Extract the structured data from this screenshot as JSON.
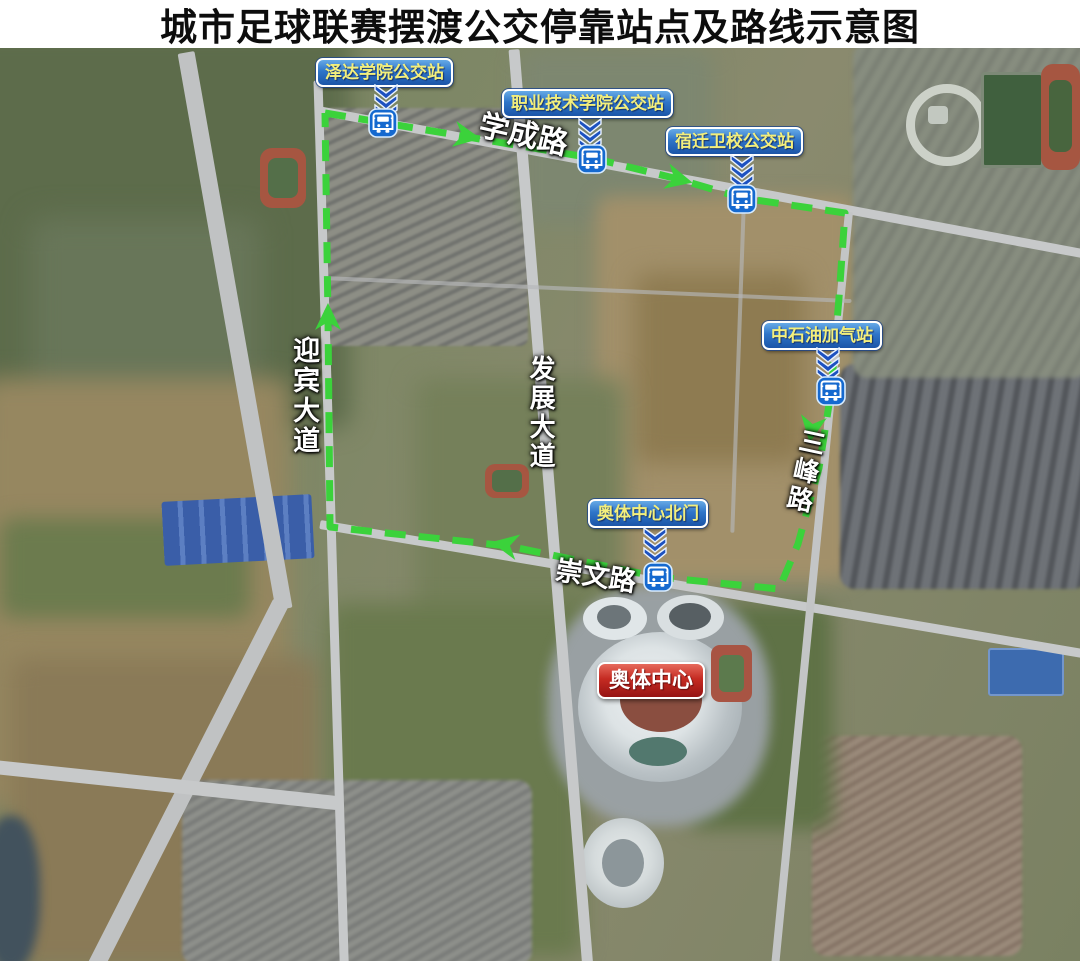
{
  "title": "城市足球联赛摆渡公交停靠站点及路线示意图",
  "map": {
    "stations": [
      {
        "id": "zeda-college",
        "name": "泽达学院公交站",
        "label": {
          "x": 316,
          "y": 10
        },
        "chevron": {
          "x": 373,
          "y": 36
        },
        "bus": {
          "x": 368,
          "y": 60
        }
      },
      {
        "id": "vocational-college",
        "name": "职业技术学院公交站",
        "label": {
          "x": 502,
          "y": 41
        },
        "chevron": {
          "x": 577,
          "y": 70
        },
        "bus": {
          "x": 577,
          "y": 96
        }
      },
      {
        "id": "suqian-health-school",
        "name": "宿迁卫校公交站",
        "label": {
          "x": 666,
          "y": 79
        },
        "chevron": {
          "x": 729,
          "y": 106
        },
        "bus": {
          "x": 727,
          "y": 136
        }
      },
      {
        "id": "petrochina-gas",
        "name": "中石油加气站",
        "label": {
          "x": 762,
          "y": 273
        },
        "chevron": {
          "x": 815,
          "y": 299
        },
        "bus": {
          "x": 816,
          "y": 328
        }
      },
      {
        "id": "octc-north-gate",
        "name": "奥体中心北门",
        "label": {
          "x": 588,
          "y": 451
        },
        "chevron": {
          "x": 642,
          "y": 479
        },
        "bus": {
          "x": 643,
          "y": 514
        }
      }
    ],
    "destination": {
      "name": "奥体中心",
      "x": 597,
      "y": 614
    },
    "roads": [
      {
        "id": "xuecheng-road",
        "name": "学成路",
        "x": 483,
        "y": 62,
        "rotate": 13,
        "vertical": false,
        "size": 30
      },
      {
        "id": "yingbin-avenue",
        "name": "迎宾大道",
        "x": 289,
        "y": 288,
        "rotate": 0,
        "vertical": true,
        "size": 27
      },
      {
        "id": "fazhan-avenue",
        "name": "发展大道",
        "x": 527,
        "y": 307,
        "rotate": 0,
        "vertical": true,
        "size": 26
      },
      {
        "id": "sanfeng-road",
        "name": "三峰路",
        "x": 800,
        "y": 378,
        "rotate": 12,
        "vertical": true,
        "size": 26
      },
      {
        "id": "chongwen-road",
        "name": "崇文路",
        "x": 558,
        "y": 508,
        "rotate": 9,
        "vertical": false,
        "size": 27
      }
    ],
    "route": {
      "color": "#3bd23b",
      "points": "325,65 468,89 592,110 678,131 742,150 845,165 839,250 831,344 819,420 798,496 779,541 658,529 508,498 330,479 328,270 325,65",
      "arrows": [
        {
          "x": 466,
          "y": 88,
          "angle": 10
        },
        {
          "x": 678,
          "y": 131,
          "angle": 14
        },
        {
          "x": 812,
          "y": 380,
          "angle": 99
        },
        {
          "x": 506,
          "y": 497,
          "angle": 191
        },
        {
          "x": 328,
          "y": 270,
          "angle": 270
        }
      ]
    }
  }
}
